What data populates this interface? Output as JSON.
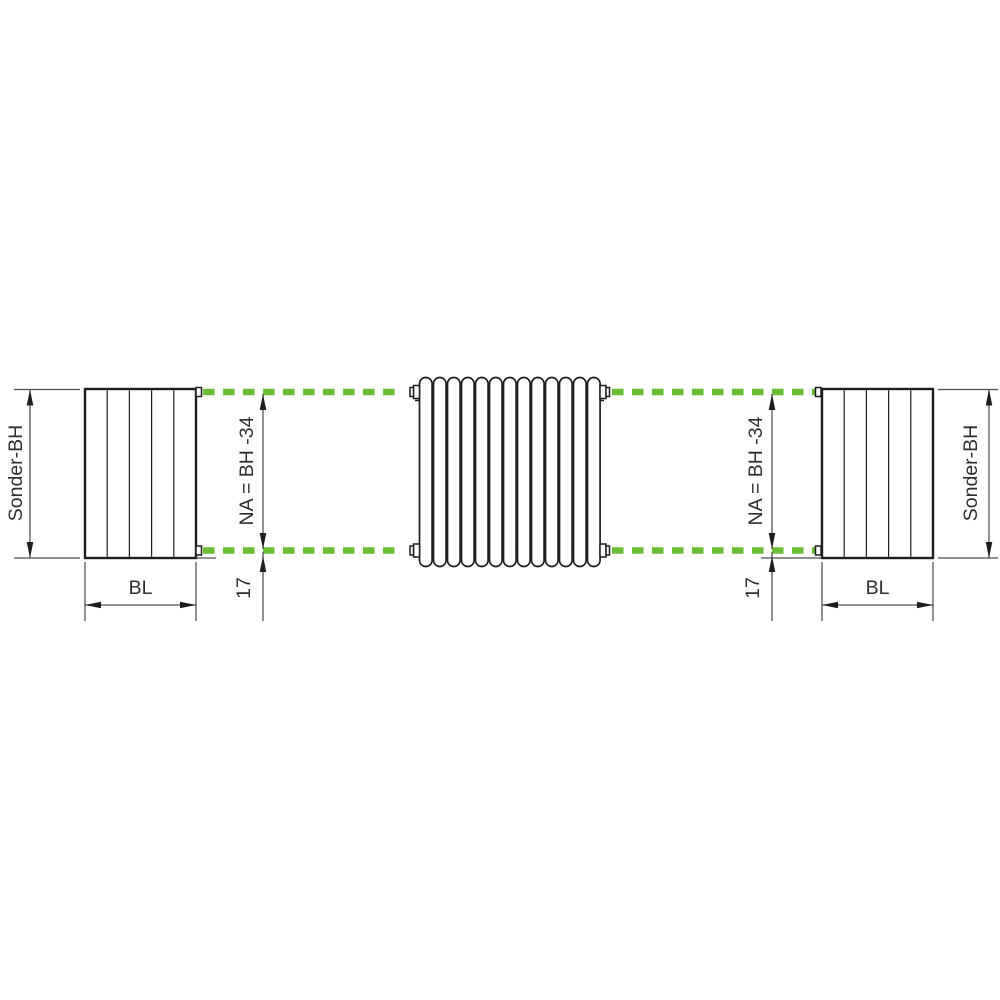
{
  "diagram": {
    "colors": {
      "connection_axis_green": "#6abe33",
      "outline_black": "#1d1d1d",
      "dimension_gray": "#4d4d4d",
      "text_dark": "#2e2e2e"
    },
    "center_front_view": {
      "tube_count": 13
    },
    "labels": {
      "height_left": "Sonder-BH",
      "height_right": "Sonder-BH",
      "width_left": "BL",
      "width_right": "BL",
      "hub_left": "NA = BH -34",
      "hub_right": "NA = BH -34",
      "offset_left": "17",
      "offset_right": "17"
    }
  }
}
